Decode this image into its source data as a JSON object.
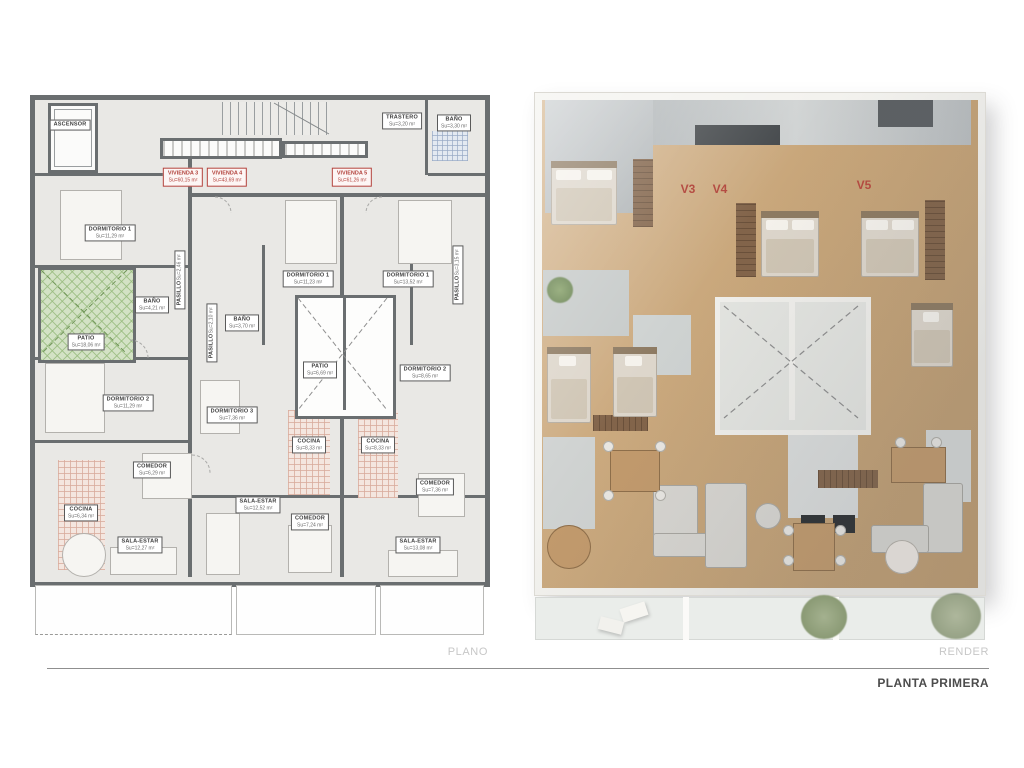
{
  "footer": {
    "plan_caption": "PLANO",
    "render_caption": "RENDER",
    "sheet_title": "PLANTA PRIMERA"
  },
  "plan": {
    "viviendas": [
      {
        "label": "VIVIENDA 3",
        "area": "Su=60,15 m²"
      },
      {
        "label": "VIVIENDA 4",
        "area": "Su=43,69 m²"
      },
      {
        "label": "VIVIENDA 5",
        "area": "Su=61,26 m²"
      }
    ],
    "rooms": [
      {
        "id": "ascensor",
        "label": "ASCENSOR",
        "area": ""
      },
      {
        "id": "trastero",
        "label": "TRASTERO",
        "area": "Su=3,20 m²"
      },
      {
        "id": "bano-comun",
        "label": "BAÑO",
        "area": "Su=3,30 m²"
      },
      {
        "id": "dorm1-v3",
        "label": "DORMITORIO 1",
        "area": "Su=11,29 m²"
      },
      {
        "id": "patio-v3",
        "label": "PATIO",
        "area": "Su=18,06 m²"
      },
      {
        "id": "bano-v3",
        "label": "BAÑO",
        "area": "Su=4,21 m²"
      },
      {
        "id": "pasillo-v3",
        "label": "PASILLO",
        "area": "Su=2,46 m²"
      },
      {
        "id": "pasillo-v4",
        "label": "PASILLO",
        "area": "Su=2,10 m²"
      },
      {
        "id": "pasillo-v5",
        "label": "PASILLO",
        "area": "Su=3,15 m²"
      },
      {
        "id": "dorm1-v4",
        "label": "DORMITORIO 1",
        "area": "Su=11,23 m²"
      },
      {
        "id": "dorm1-v5",
        "label": "DORMITORIO 1",
        "area": "Su=13,52 m²"
      },
      {
        "id": "bano-v4",
        "label": "BAÑO",
        "area": "Su=3,70 m²"
      },
      {
        "id": "patio-central",
        "label": "PATIO",
        "area": "Su=6,69 m²"
      },
      {
        "id": "dorm2-v5",
        "label": "DORMITORIO 2",
        "area": "Su=8,65 m²"
      },
      {
        "id": "dorm2-v3",
        "label": "DORMITORIO 2",
        "area": "Su=11,29 m²"
      },
      {
        "id": "dorm3-v4",
        "label": "DORMITORIO 3",
        "area": "Su=7,36 m²"
      },
      {
        "id": "cocina-v4",
        "label": "COCINA",
        "area": "Su=8,33 m²"
      },
      {
        "id": "cocina-v5",
        "label": "COCINA",
        "area": "Su=8,33 m²"
      },
      {
        "id": "comedor-v3",
        "label": "COMEDOR",
        "area": "Su=6,29 m²"
      },
      {
        "id": "cocina-v3",
        "label": "COCINA",
        "area": "Su=6,34 m²"
      },
      {
        "id": "sala-v3",
        "label": "SALA-ESTAR",
        "area": "Su=12,27 m²"
      },
      {
        "id": "sala-v4",
        "label": "SALA-ESTAR",
        "area": "Su=12,52 m²"
      },
      {
        "id": "comedor-v4",
        "label": "COMEDOR",
        "area": "Su=7,24 m²"
      },
      {
        "id": "comedor-v5",
        "label": "COMEDOR",
        "area": "Su=7,36 m²"
      },
      {
        "id": "sala-v5",
        "label": "SALA-ESTAR",
        "area": "Su=13,08 m²"
      }
    ]
  },
  "render": {
    "markers": [
      {
        "label": "V3"
      },
      {
        "label": "V4"
      },
      {
        "label": "V5"
      }
    ]
  },
  "colors": {
    "accent_red": "#b2423c",
    "wall_gray": "#6a6e70",
    "patio_green": "#d3e2c5",
    "kitchen_pink": "#f4e6df",
    "render_wood": "#c8a67a"
  }
}
